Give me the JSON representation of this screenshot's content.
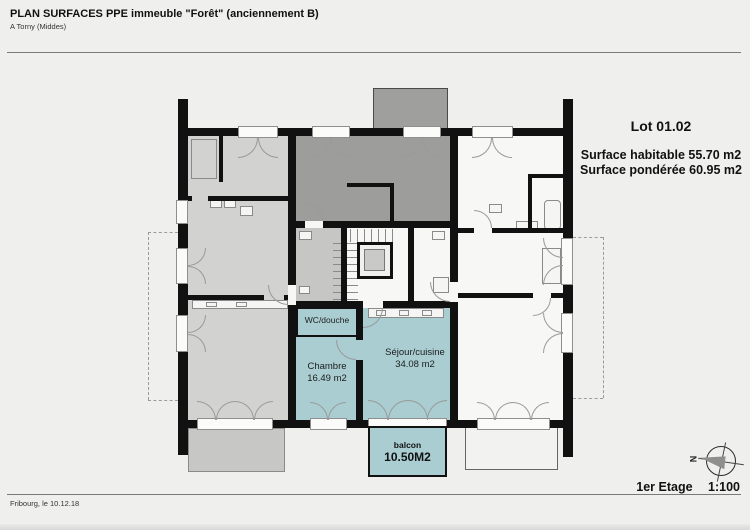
{
  "header": {
    "title": "PLAN SURFACES PPE immeuble \"Forêt\" (anciennement B)",
    "subtitle": "A Torny (Middes)"
  },
  "lot_info": {
    "lot_label": "Lot 01.02",
    "surface_habitable": "Surface habitable 55.70 m2",
    "surface_ponderee": "Surface pondérée 60.95 m2"
  },
  "plan": {
    "rooms": {
      "wc_douche": {
        "label": "WC/douche"
      },
      "chambre": {
        "label": "Chambre",
        "area": "16.49 m2"
      },
      "sejour_cuisine": {
        "label": "Séjour/cuisine",
        "area": "34.08 m2"
      },
      "balcon": {
        "label": "balcon",
        "area": "10.50M2"
      }
    },
    "compass": {
      "north_label": "N"
    }
  },
  "footer": {
    "place_date": "Fribourg, le 10.12.18",
    "floor_label": "1er Etage",
    "scale": "1:100"
  },
  "colors": {
    "lot_teal": "#a9cdd1",
    "other_unit_dark": "#9d9d9b",
    "other_unit_light": "#d2d2d0",
    "wall_black": "#111111",
    "balcony_gray": "#c7c7c5",
    "paper": "#efefed"
  }
}
